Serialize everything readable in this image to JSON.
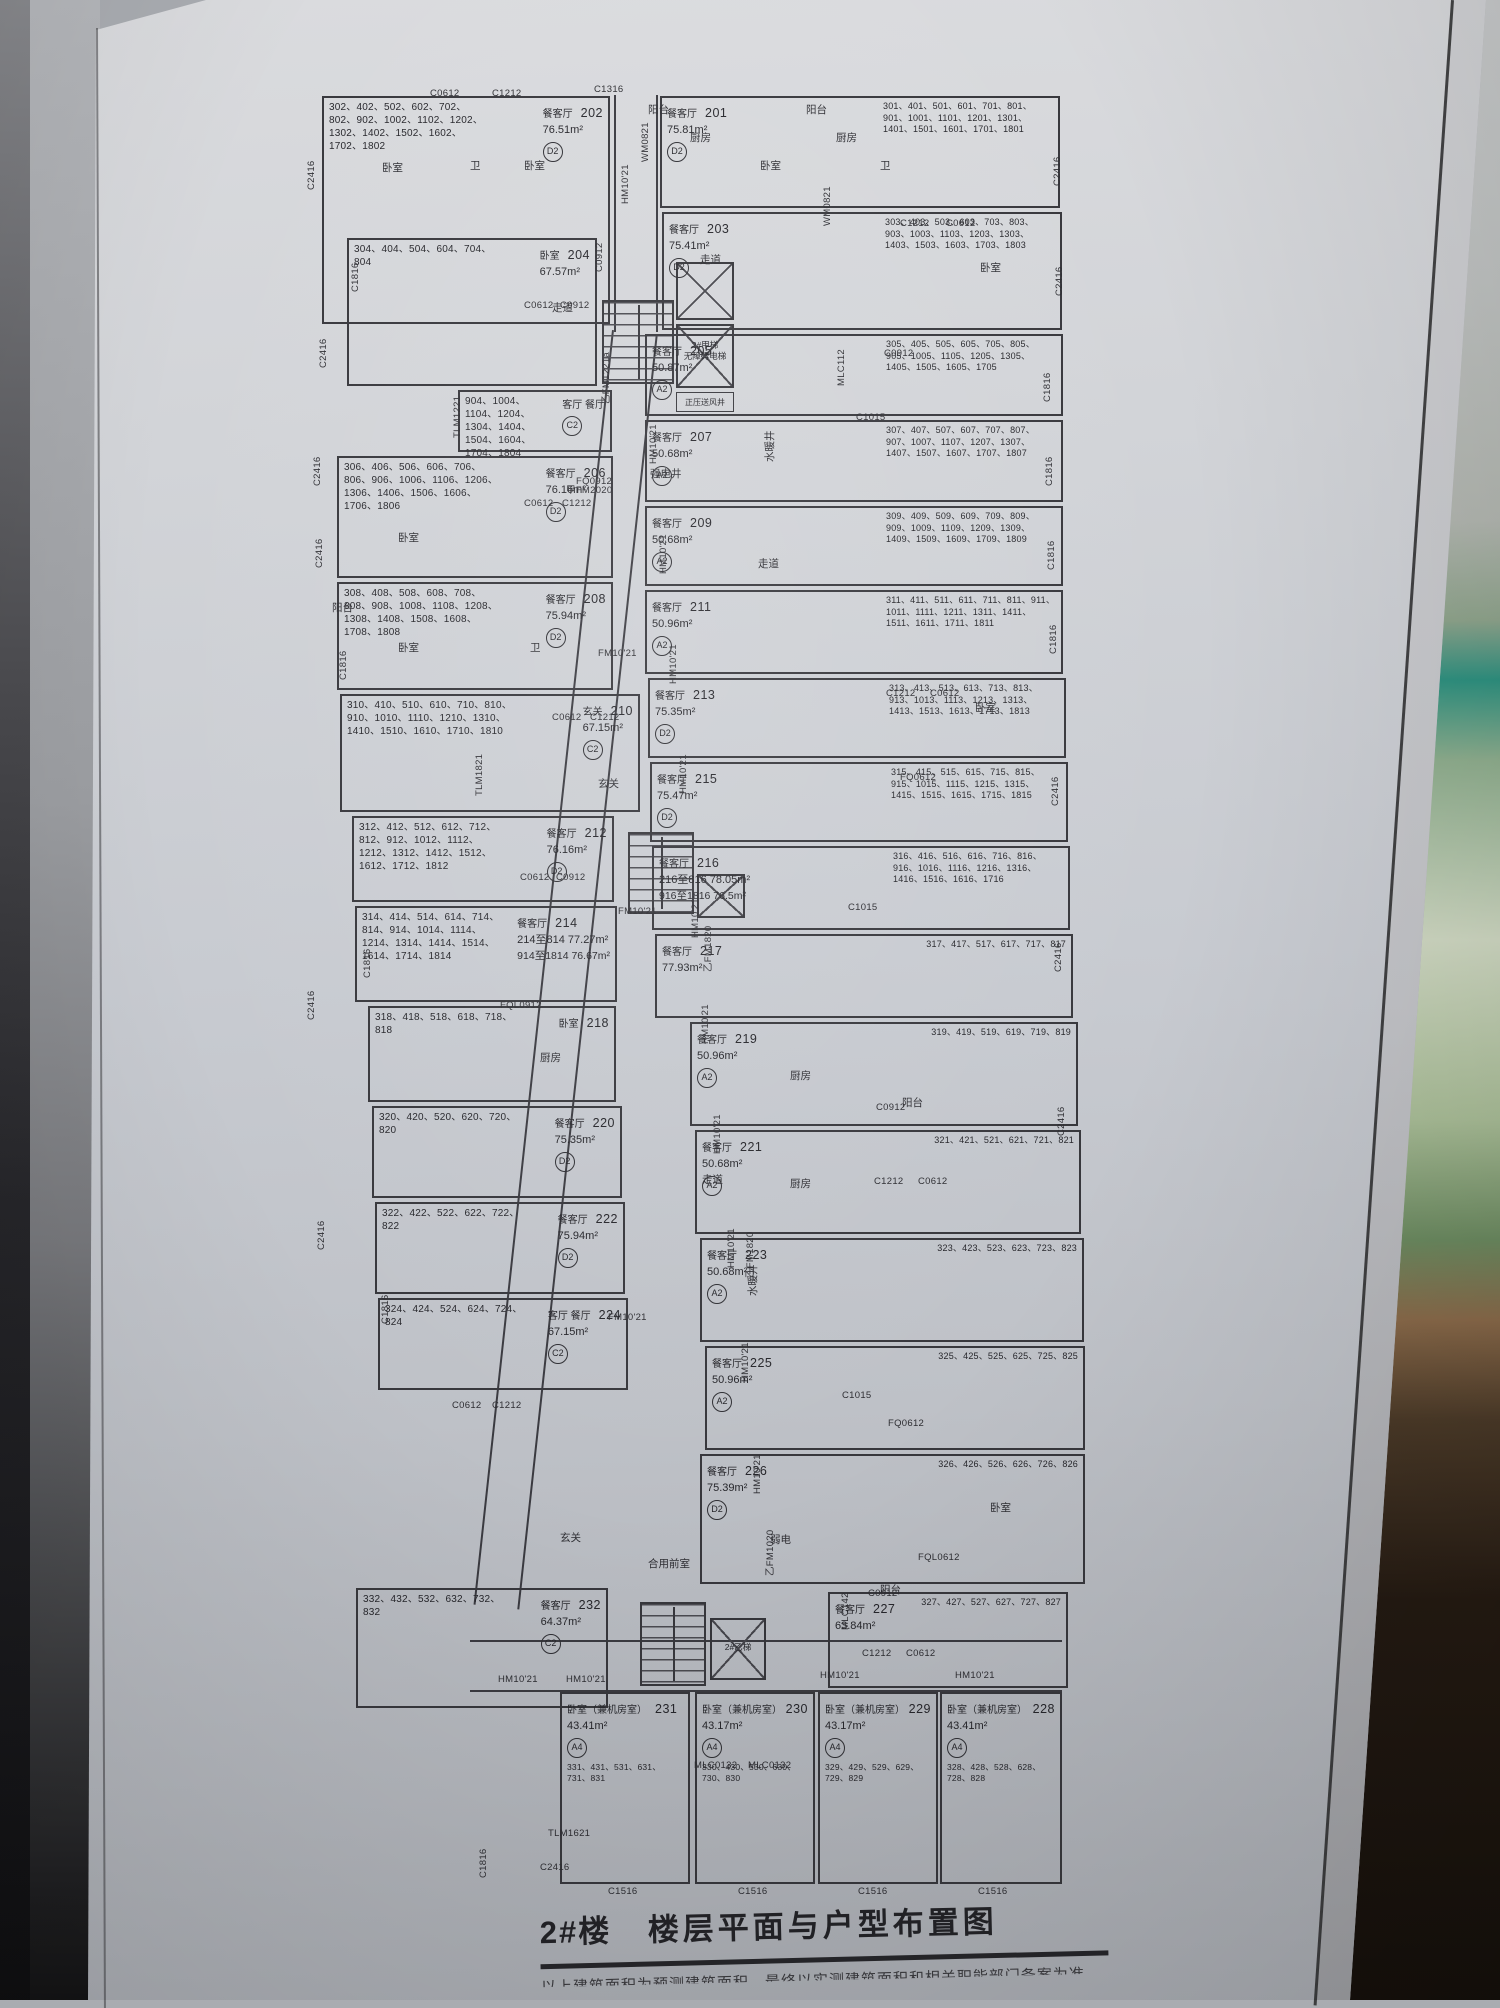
{
  "photo": {
    "colors": {
      "poster_paper": "#c8cbd1",
      "plan_ink": "#37373c",
      "frame_dark": "#26262a",
      "glass_green": "#8fae8e",
      "tape_teal": "#2e9180",
      "wood_brown": "#4b3a28"
    }
  },
  "poster": {
    "title": {
      "building": "2#楼",
      "name": "楼层平面与户型布置图",
      "note": "以上建筑面积为预测建筑面积，最终以实测建筑面积和相关职能部门备案为准"
    }
  },
  "plan": {
    "cores": {
      "elevator_main": "2#甲梯",
      "elevator_main_sub": "无障碍电梯",
      "vent": "正压送风井",
      "elevator_b": "2#乙梯",
      "lobby": "合用前室",
      "strong_elec": "强电井",
      "water_shaft": "水暖井",
      "weak_elec": "弱电"
    },
    "units": [
      {
        "no": "202",
        "room": "餐客厅",
        "mark": "D2",
        "area": "76.51m²",
        "floors": "302、402、502、602、702、802、902、1002、1102、1202、1302、1402、1502、1602、1702、1802",
        "x": 322,
        "y": 96,
        "w": 288,
        "h": 228,
        "fs": "L"
      },
      {
        "no": "204",
        "room": "卧室",
        "mark": "",
        "area": "67.57m²",
        "floors": "304、404、504、604、704、804",
        "x": 347,
        "y": 238,
        "w": 250,
        "h": 148,
        "fs": "L"
      },
      {
        "no": "",
        "room": "客厅  餐厅",
        "mark": "C2",
        "area": "",
        "floors": "904、1004、1104、1204、1304、1404、1504、1604、1704、1804",
        "x": 458,
        "y": 390,
        "w": 154,
        "h": 62,
        "fs": "L"
      },
      {
        "no": "206",
        "room": "餐客厅",
        "mark": "D2",
        "area": "76.16m²",
        "floors": "306、406、506、606、706、806、906、1006、1106、1206、1306、1406、1506、1606、1706、1806",
        "x": 337,
        "y": 456,
        "w": 276,
        "h": 122,
        "fs": "L"
      },
      {
        "no": "208",
        "room": "餐客厅",
        "mark": "D2",
        "area": "75.94m²",
        "floors": "308、408、508、608、708、808、908、1008、1108、1208、1308、1408、1508、1608、1708、1808",
        "x": 337,
        "y": 582,
        "w": 276,
        "h": 108,
        "fs": "L"
      },
      {
        "no": "210",
        "room": "玄关",
        "mark": "C2",
        "area": "67.15m²",
        "floors": "310、410、510、610、710、810、910、1010、1110、1210、1310、1410、1510、1610、1710、1810",
        "x": 340,
        "y": 694,
        "w": 300,
        "h": 118,
        "fs": "L"
      },
      {
        "no": "212",
        "room": "餐客厅",
        "mark": "D2",
        "area": "76.16m²",
        "floors": "312、412、512、612、712、812、912、1012、1112、1212、1312、1412、1512、1612、1712、1812",
        "x": 352,
        "y": 816,
        "w": 262,
        "h": 86,
        "fs": "L"
      },
      {
        "no": "214",
        "room": "餐客厅",
        "mark": "",
        "area": "214至814 77.27m²",
        "area2": "914至1814 76.67m²",
        "floors": "314、414、514、614、714、814、914、1014、1114、1214、1314、1414、1514、1614、1714、1814",
        "x": 355,
        "y": 906,
        "w": 262,
        "h": 96,
        "fs": "L"
      },
      {
        "no": "218",
        "room": "卧室",
        "mark": "",
        "area": "",
        "floors": "318、418、518、618、718、818",
        "x": 368,
        "y": 1006,
        "w": 248,
        "h": 96,
        "fs": "L"
      },
      {
        "no": "220",
        "room": "餐客厅",
        "mark": "D2",
        "area": "75.35m²",
        "floors": "320、420、520、620、720、820",
        "x": 372,
        "y": 1106,
        "w": 250,
        "h": 92,
        "fs": "L"
      },
      {
        "no": "222",
        "room": "餐客厅",
        "mark": "D2",
        "area": "75.94m²",
        "floors": "322、422、522、622、722、822",
        "x": 375,
        "y": 1202,
        "w": 250,
        "h": 92,
        "fs": "L"
      },
      {
        "no": "224",
        "room": "客厅  餐厅",
        "mark": "C2",
        "area": "67.15m²",
        "floors": "324、424、524、624、724、824",
        "x": 378,
        "y": 1298,
        "w": 250,
        "h": 92,
        "fs": "L"
      },
      {
        "no": "232",
        "room": "餐客厅",
        "mark": "C2",
        "area": "64.37m²",
        "floors": "332、432、532、632、732、832",
        "x": 356,
        "y": 1588,
        "w": 252,
        "h": 120,
        "fs": "L"
      },
      {
        "no": "201",
        "room": "餐客厅",
        "mark": "D2",
        "area": "75.81m²",
        "floors": "301、401、501、601、701、801、901、1001、1101、1201、1301、1401、1501、1601、1701、1801",
        "x": 660,
        "y": 96,
        "w": 400,
        "h": 112,
        "fs": "R"
      },
      {
        "no": "203",
        "room": "餐客厅",
        "mark": "D2",
        "area": "75.41m²",
        "floors": "303、403、503、603、703、803、903、1003、1103、1203、1303、1403、1503、1603、1703、1803",
        "x": 662,
        "y": 212,
        "w": 400,
        "h": 118,
        "fs": "R"
      },
      {
        "no": "205",
        "room": "餐客厅",
        "mark": "A2",
        "area": "50.87m²",
        "floors": "305、405、505、605、705、805、905、1005、1105、1205、1305、1405、1505、1605、1705",
        "x": 645,
        "y": 334,
        "w": 418,
        "h": 82,
        "fs": "R"
      },
      {
        "no": "207",
        "room": "餐客厅",
        "mark": "A2",
        "area": "50.68m²",
        "floors": "307、407、507、607、707、807、907、1007、1107、1207、1307、1407、1507、1607、1707、1807",
        "x": 645,
        "y": 420,
        "w": 418,
        "h": 82,
        "fs": "R"
      },
      {
        "no": "209",
        "room": "餐客厅",
        "mark": "A2",
        "area": "50.68m²",
        "floors": "309、409、509、609、709、809、909、1009、1109、1209、1309、1409、1509、1609、1709、1809",
        "x": 645,
        "y": 506,
        "w": 418,
        "h": 80,
        "fs": "R"
      },
      {
        "no": "211",
        "room": "餐客厅",
        "mark": "A2",
        "area": "50.96m²",
        "floors": "311、411、511、611、711、811、911、1011、1111、1211、1311、1411、1511、1611、1711、1811",
        "x": 645,
        "y": 590,
        "w": 418,
        "h": 84,
        "fs": "R"
      },
      {
        "no": "213",
        "room": "餐客厅",
        "mark": "D2",
        "area": "75.35m²",
        "floors": "313、413、513、613、713、813、913、1013、1113、1213、1313、1413、1513、1613、1713、1813",
        "x": 648,
        "y": 678,
        "w": 418,
        "h": 80,
        "fs": "R"
      },
      {
        "no": "215",
        "room": "餐客厅",
        "mark": "D2",
        "area": "75.47m²",
        "floors": "315、415、515、615、715、815、915、1015、1115、1215、1315、1415、1515、1615、1715、1815",
        "x": 650,
        "y": 762,
        "w": 418,
        "h": 80,
        "fs": "R"
      },
      {
        "no": "216",
        "room": "餐客厅",
        "mark": "",
        "area": "216至816 78.05m²",
        "area2": "916至1816 76.5m²",
        "floors": "316、416、516、616、716、816、916、1016、1116、1216、1316、1416、1516、1616、1716",
        "x": 652,
        "y": 846,
        "w": 418,
        "h": 84,
        "fs": "R"
      },
      {
        "no": "217",
        "room": "餐客厅",
        "mark": "",
        "area": "77.93m²",
        "floors": "317、417、517、617、717、817",
        "x": 655,
        "y": 934,
        "w": 418,
        "h": 84,
        "fs": "R"
      },
      {
        "no": "219",
        "room": "餐客厅",
        "mark": "A2",
        "area": "50.96m²",
        "floors": "319、419、519、619、719、819",
        "x": 690,
        "y": 1022,
        "w": 388,
        "h": 104,
        "fs": "R"
      },
      {
        "no": "221",
        "room": "餐客厅",
        "mark": "A2",
        "area": "50.68m²",
        "floors": "321、421、521、621、721、821",
        "x": 695,
        "y": 1130,
        "w": 386,
        "h": 104,
        "fs": "R"
      },
      {
        "no": "223",
        "room": "餐客厅",
        "mark": "A2",
        "area": "50.68m²",
        "floors": "323、423、523、623、723、823",
        "x": 700,
        "y": 1238,
        "w": 384,
        "h": 104,
        "fs": "R"
      },
      {
        "no": "225",
        "room": "餐客厅",
        "mark": "A2",
        "area": "50.96m²",
        "floors": "325、425、525、625、725、825",
        "x": 705,
        "y": 1346,
        "w": 380,
        "h": 104,
        "fs": "R"
      },
      {
        "no": "226",
        "room": "餐客厅",
        "mark": "D2",
        "area": "75.39m²",
        "floors": "326、426、526、626、726、826",
        "x": 700,
        "y": 1454,
        "w": 385,
        "h": 130,
        "fs": "R"
      },
      {
        "no": "227",
        "room": "餐客厅",
        "mark": "",
        "area": "63.84m²",
        "floors": "327、427、527、627、727、827",
        "x": 828,
        "y": 1592,
        "w": 240,
        "h": 96,
        "fs": "R"
      },
      {
        "no": "231",
        "room": "卧室（兼机房室）",
        "mark": "A4",
        "area": "43.41m²",
        "floors": "331、431、531、631、731、831",
        "x": 560,
        "y": 1692,
        "w": 130,
        "h": 192,
        "fs": "L",
        "cls": "rev"
      },
      {
        "no": "230",
        "room": "卧室（兼机房室）",
        "mark": "A4",
        "area": "43.17m²",
        "floors": "330、430、530、630、730、830",
        "x": 695,
        "y": 1692,
        "w": 120,
        "h": 192,
        "fs": "L",
        "cls": "rev"
      },
      {
        "no": "229",
        "room": "卧室（兼机房室）",
        "mark": "A4",
        "area": "43.17m²",
        "floors": "329、429、529、629、729、829",
        "x": 818,
        "y": 1692,
        "w": 120,
        "h": 192,
        "fs": "L",
        "cls": "rev"
      },
      {
        "no": "228",
        "room": "卧室（兼机房室）",
        "mark": "A4",
        "area": "43.41m²",
        "floors": "328、428、528、628、728、828",
        "x": 940,
        "y": 1692,
        "w": 122,
        "h": 192,
        "fs": "L",
        "cls": "rev"
      }
    ],
    "window_codes": [
      {
        "t": "C1316",
        "x": 594,
        "y": 84
      },
      {
        "t": "C0612",
        "x": 430,
        "y": 88
      },
      {
        "t": "C1212",
        "x": 492,
        "y": 88
      },
      {
        "t": "C2416",
        "x": 306,
        "y": 190,
        "v": 1
      },
      {
        "t": "C0912",
        "x": 594,
        "y": 272,
        "v": 1
      },
      {
        "t": "C1816",
        "x": 350,
        "y": 292,
        "v": 1
      },
      {
        "t": "C0612",
        "x": 524,
        "y": 300
      },
      {
        "t": "C0912",
        "x": 560,
        "y": 300
      },
      {
        "t": "C2416",
        "x": 318,
        "y": 368,
        "v": 1
      },
      {
        "t": "TLM1221",
        "x": 452,
        "y": 438,
        "v": 1
      },
      {
        "t": "FQ0912",
        "x": 576,
        "y": 476
      },
      {
        "t": "C0612",
        "x": 524,
        "y": 498
      },
      {
        "t": "C1212",
        "x": 562,
        "y": 498
      },
      {
        "t": "C2416",
        "x": 312,
        "y": 486,
        "v": 1
      },
      {
        "t": "C2416",
        "x": 314,
        "y": 568,
        "v": 1
      },
      {
        "t": "C1816",
        "x": 338,
        "y": 680,
        "v": 1
      },
      {
        "t": "C0612",
        "x": 552,
        "y": 712
      },
      {
        "t": "C1212",
        "x": 590,
        "y": 712
      },
      {
        "t": "TLM1821",
        "x": 474,
        "y": 796,
        "v": 1
      },
      {
        "t": "C2416",
        "x": 306,
        "y": 1020,
        "v": 1
      },
      {
        "t": "C1816",
        "x": 362,
        "y": 978,
        "v": 1
      },
      {
        "t": "C0612",
        "x": 520,
        "y": 872
      },
      {
        "t": "C0912",
        "x": 556,
        "y": 872
      },
      {
        "t": "FQL0912",
        "x": 500,
        "y": 1000
      },
      {
        "t": "C2416",
        "x": 316,
        "y": 1250,
        "v": 1
      },
      {
        "t": "C1816",
        "x": 380,
        "y": 1324,
        "v": 1
      },
      {
        "t": "C0612",
        "x": 452,
        "y": 1400
      },
      {
        "t": "C1212",
        "x": 492,
        "y": 1400
      },
      {
        "t": "C1816",
        "x": 478,
        "y": 1878,
        "v": 1
      },
      {
        "t": "C2416",
        "x": 540,
        "y": 1862
      },
      {
        "t": "TLM1621",
        "x": 548,
        "y": 1828
      },
      {
        "t": "C1516",
        "x": 608,
        "y": 1886
      },
      {
        "t": "C1516",
        "x": 738,
        "y": 1886
      },
      {
        "t": "C1516",
        "x": 858,
        "y": 1886
      },
      {
        "t": "C1516",
        "x": 978,
        "y": 1886
      },
      {
        "t": "C1212",
        "x": 900,
        "y": 218
      },
      {
        "t": "C0612",
        "x": 946,
        "y": 218
      },
      {
        "t": "C2416",
        "x": 1052,
        "y": 186,
        "v": 1
      },
      {
        "t": "C2416",
        "x": 1054,
        "y": 296,
        "v": 1
      },
      {
        "t": "WM0821",
        "x": 640,
        "y": 162,
        "v": 1
      },
      {
        "t": "WM0821",
        "x": 822,
        "y": 226,
        "v": 1
      },
      {
        "t": "MLC112",
        "x": 836,
        "y": 386,
        "v": 1
      },
      {
        "t": "C1015",
        "x": 856,
        "y": 412
      },
      {
        "t": "C0912",
        "x": 884,
        "y": 348
      },
      {
        "t": "C1816",
        "x": 1042,
        "y": 402,
        "v": 1
      },
      {
        "t": "C1816",
        "x": 1044,
        "y": 486,
        "v": 1
      },
      {
        "t": "C1816",
        "x": 1046,
        "y": 570,
        "v": 1
      },
      {
        "t": "C1816",
        "x": 1048,
        "y": 654,
        "v": 1
      },
      {
        "t": "C1212",
        "x": 886,
        "y": 688
      },
      {
        "t": "C0612",
        "x": 930,
        "y": 688
      },
      {
        "t": "FQ0612",
        "x": 900,
        "y": 772
      },
      {
        "t": "C2416",
        "x": 1050,
        "y": 806,
        "v": 1
      },
      {
        "t": "C2416",
        "x": 1053,
        "y": 972,
        "v": 1
      },
      {
        "t": "C2416",
        "x": 1056,
        "y": 1136,
        "v": 1
      },
      {
        "t": "C1015",
        "x": 848,
        "y": 902
      },
      {
        "t": "C0912",
        "x": 876,
        "y": 1102
      },
      {
        "t": "C1212",
        "x": 874,
        "y": 1176
      },
      {
        "t": "C0612",
        "x": 918,
        "y": 1176
      },
      {
        "t": "C1015",
        "x": 842,
        "y": 1390
      },
      {
        "t": "FQ0612",
        "x": 888,
        "y": 1418
      },
      {
        "t": "C1212",
        "x": 862,
        "y": 1648
      },
      {
        "t": "C0612",
        "x": 906,
        "y": 1648
      },
      {
        "t": "FQL0612",
        "x": 918,
        "y": 1552
      },
      {
        "t": "C0912",
        "x": 868,
        "y": 1588
      },
      {
        "t": "MLC142",
        "x": 840,
        "y": 1630,
        "v": 1
      },
      {
        "t": "MLC0132",
        "x": 694,
        "y": 1760
      },
      {
        "t": "MLC0132",
        "x": 748,
        "y": 1760
      },
      {
        "t": "HM10'21",
        "x": 620,
        "y": 204,
        "v": 1
      },
      {
        "t": "HM10'21",
        "x": 648,
        "y": 464,
        "v": 1
      },
      {
        "t": "HM10'21",
        "x": 658,
        "y": 574,
        "v": 1
      },
      {
        "t": "HM10'21",
        "x": 668,
        "y": 684,
        "v": 1
      },
      {
        "t": "HM10'21",
        "x": 678,
        "y": 794,
        "v": 1
      },
      {
        "t": "HM10'21",
        "x": 690,
        "y": 938,
        "v": 1
      },
      {
        "t": "HM10'21",
        "x": 700,
        "y": 1044,
        "v": 1
      },
      {
        "t": "HM10'21",
        "x": 712,
        "y": 1154,
        "v": 1
      },
      {
        "t": "HM10'21",
        "x": 726,
        "y": 1268,
        "v": 1
      },
      {
        "t": "HM10'21",
        "x": 740,
        "y": 1382,
        "v": 1
      },
      {
        "t": "HM10'21",
        "x": 752,
        "y": 1494,
        "v": 1
      },
      {
        "t": "HM10'21",
        "x": 498,
        "y": 1674
      },
      {
        "t": "HM10'21",
        "x": 566,
        "y": 1674
      },
      {
        "t": "HM10'21",
        "x": 820,
        "y": 1670
      },
      {
        "t": "HM10'21",
        "x": 955,
        "y": 1670
      },
      {
        "t": "FM10'21",
        "x": 598,
        "y": 648
      },
      {
        "t": "甲FM2020",
        "x": 566,
        "y": 482
      },
      {
        "t": "乙FM1221а",
        "x": 598,
        "y": 404,
        "v": 1
      },
      {
        "t": "乙FM1820",
        "x": 700,
        "y": 972,
        "v": 1
      },
      {
        "t": "乙FM1820",
        "x": 742,
        "y": 1278,
        "v": 1
      },
      {
        "t": "乙FM1020",
        "x": 762,
        "y": 1576,
        "v": 1
      },
      {
        "t": "FM10'21",
        "x": 608,
        "y": 1312
      },
      {
        "t": "FM10'21",
        "x": 618,
        "y": 906
      }
    ],
    "room_labels": [
      {
        "t": "厨房",
        "x": 690,
        "y": 130
      },
      {
        "t": "厨房",
        "x": 836,
        "y": 130
      },
      {
        "t": "阳台",
        "x": 648,
        "y": 102
      },
      {
        "t": "阳台",
        "x": 806,
        "y": 102
      },
      {
        "t": "卧室",
        "x": 382,
        "y": 160
      },
      {
        "t": "卫",
        "x": 470,
        "y": 158
      },
      {
        "t": "卧室",
        "x": 524,
        "y": 158
      },
      {
        "t": "卧室",
        "x": 760,
        "y": 158
      },
      {
        "t": "卫",
        "x": 880,
        "y": 158
      },
      {
        "t": "走道",
        "x": 700,
        "y": 252
      },
      {
        "t": "走道",
        "x": 552,
        "y": 300
      },
      {
        "t": "走道",
        "x": 758,
        "y": 556
      },
      {
        "t": "走道",
        "x": 702,
        "y": 1172
      },
      {
        "t": "阳台",
        "x": 332,
        "y": 600
      },
      {
        "t": "阳台",
        "x": 902,
        "y": 1095
      },
      {
        "t": "阳台",
        "x": 880,
        "y": 1582
      },
      {
        "t": "玄关",
        "x": 598,
        "y": 776
      },
      {
        "t": "玄关",
        "x": 560,
        "y": 1530
      },
      {
        "t": "强电井",
        "x": 650,
        "y": 466
      },
      {
        "t": "水暖井",
        "x": 762,
        "y": 462,
        "v": 1
      },
      {
        "t": "水暖井",
        "x": 745,
        "y": 1296,
        "v": 1
      },
      {
        "t": "弱电",
        "x": 770,
        "y": 1532
      },
      {
        "t": "卧室",
        "x": 398,
        "y": 530
      },
      {
        "t": "卧室",
        "x": 398,
        "y": 640
      },
      {
        "t": "卫",
        "x": 530,
        "y": 640
      },
      {
        "t": "厨房",
        "x": 540,
        "y": 1050
      },
      {
        "t": "厨房",
        "x": 790,
        "y": 1068
      },
      {
        "t": "厨房",
        "x": 790,
        "y": 1176
      },
      {
        "t": "卧室",
        "x": 980,
        "y": 260
      },
      {
        "t": "卧室",
        "x": 975,
        "y": 700
      },
      {
        "t": "卧室",
        "x": 990,
        "y": 1500
      }
    ]
  }
}
